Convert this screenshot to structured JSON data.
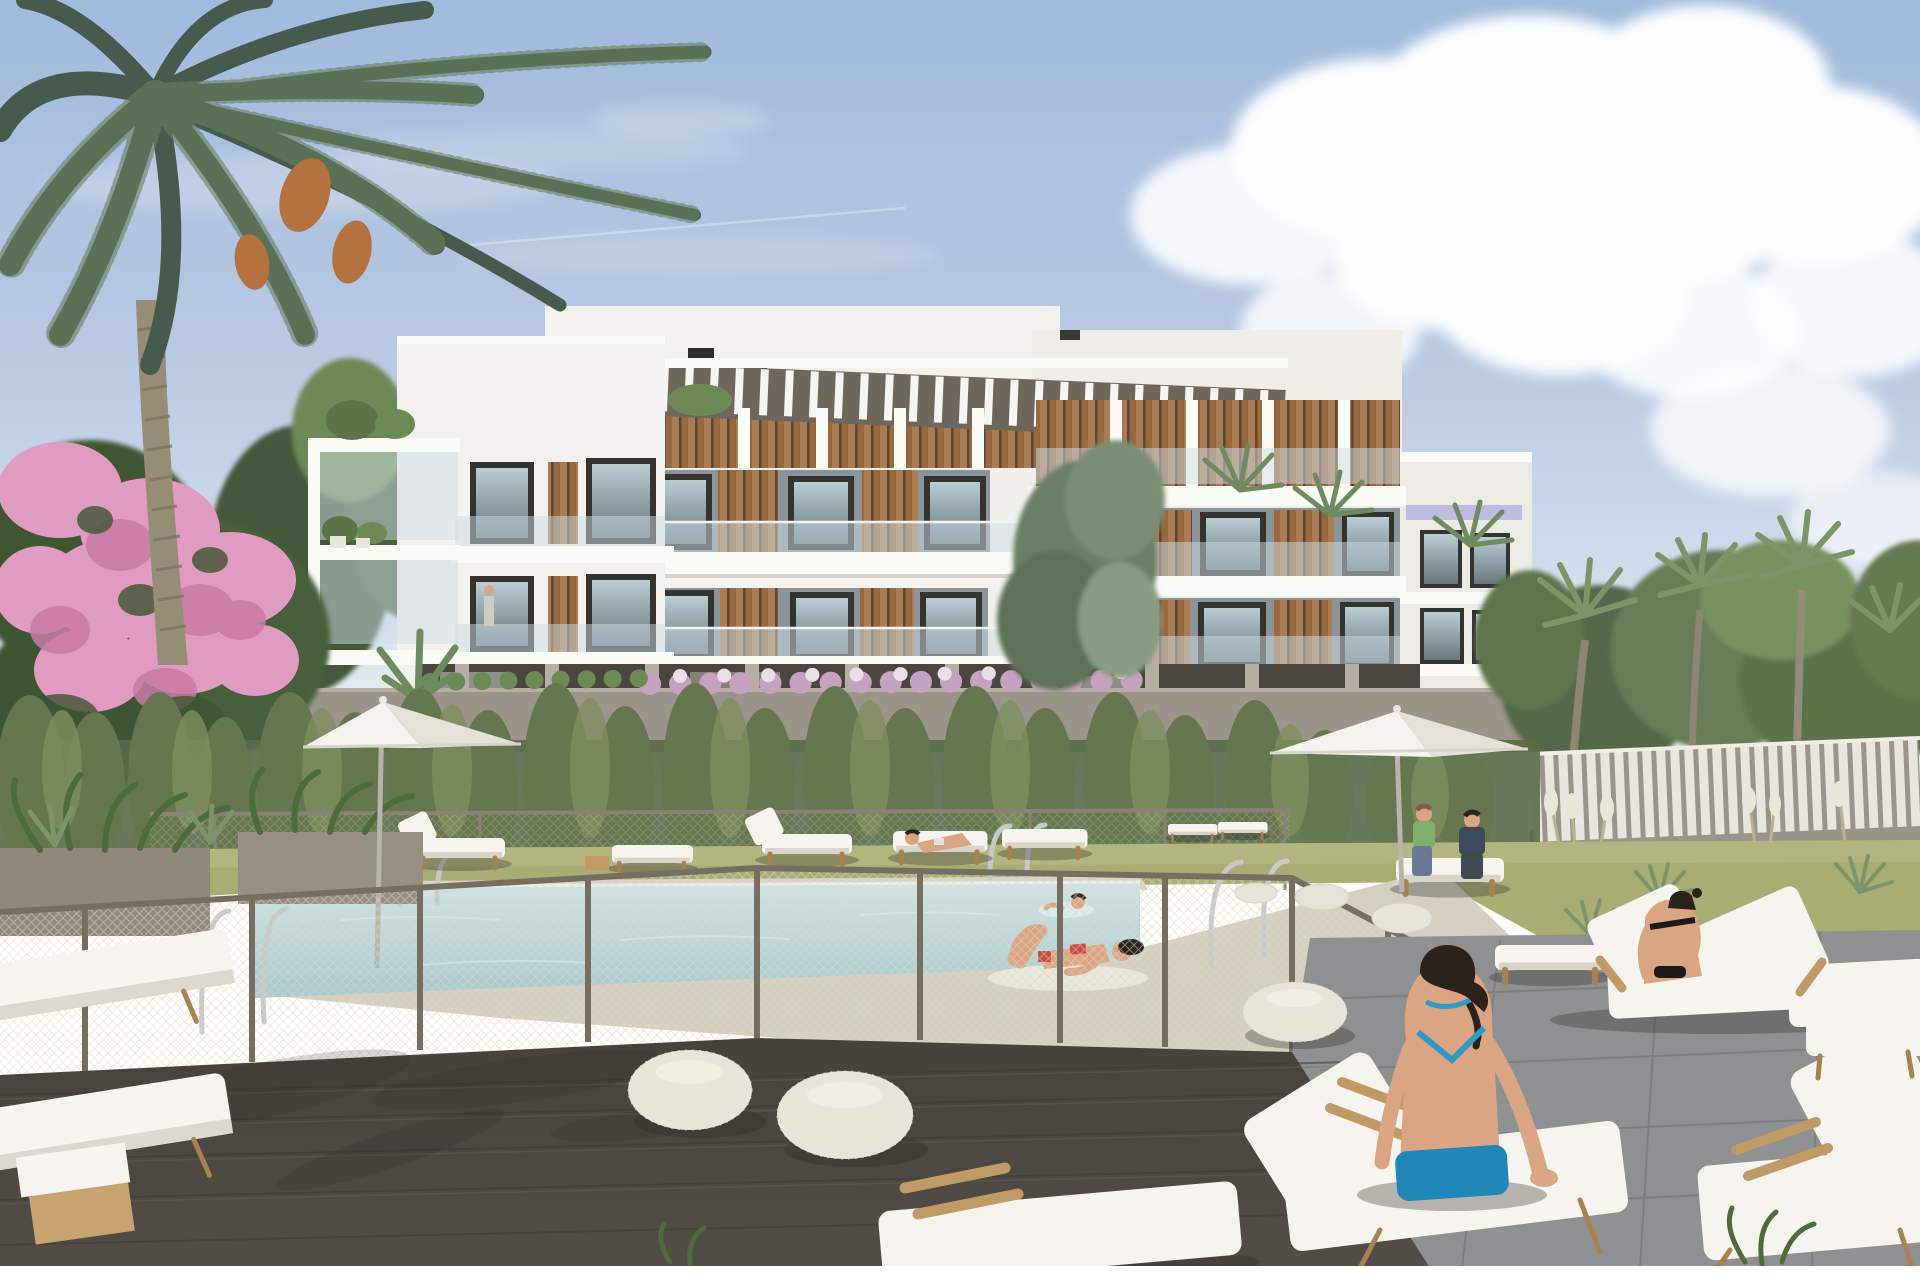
{
  "scene": {
    "type": "exterior architectural rendering",
    "description": "Modern white three-storey apartment building with timber louvres and a rooftop pergola behind a landscaped garden; fenced swimming pool with a swimmer and sunbathers, wooden deck with white sun loungers, knitted poufs, two white parasols, a tall date palm and a pink bougainvillea under a blue sky with cumulus clouds",
    "sky": {
      "clouds": "large cumulus on the right, thin haze and a faint contrail on the left"
    },
    "building": {
      "storeys": 3,
      "features": [
        "glass balcony railings",
        "timber louvre panels",
        "roof pergola",
        "pilotis ground floor",
        "roof chimneys"
      ]
    },
    "pool": {
      "enclosure": "chain-link fence",
      "ladders": 3,
      "swimmers": 1
    },
    "parasols": 2,
    "poufs": 6,
    "people": [
      {
        "where": "pool",
        "pose": "swimming"
      },
      {
        "where": "poolside deck",
        "pose": "lying on towel, red bikini"
      },
      {
        "where": "lounger behind pool",
        "pose": "sunbathing"
      },
      {
        "where": "garden loungers at right",
        "pose": "seated couple talking"
      },
      {
        "where": "double lounger right",
        "pose": "seated woman, black bikini"
      },
      {
        "where": "foreground deck",
        "pose": "woman seated from behind, blue bikini"
      }
    ],
    "vegetation": [
      "date palm",
      "pink bougainvillea",
      "conifers",
      "cypress hedge",
      "olive tree",
      "fan palms",
      "agaves",
      "white plume grasses"
    ]
  },
  "palette": {
    "sky_top": "#9fbbdd",
    "sky_mid": "#b5c7e2",
    "sky_horizon": "#e9eef1",
    "cloud": "#fdfdfd",
    "building_white": "#f2f1ed",
    "building_shade": "#ddd9d1",
    "slab": "#fafaf7",
    "window_frame": "#35332f",
    "glass_light": "#b9cdd3",
    "glass_dark": "#69787e",
    "louvre_wood": "#a87c54",
    "pergola_dark": "#6e675e",
    "pilotis_shadow": "#4a463f",
    "column": "#b5afa4",
    "garden_wall": "#9b948a",
    "flower_purple": "#c5a3c0",
    "bougainvillea": "#df9cc0",
    "conifer": "#44583a",
    "foliage": "#5d7348",
    "hedge": "#66764e",
    "grass": "#a8ad74",
    "agave": "#7d9468",
    "water": "#b9d6da",
    "water_far": "#cfe4e6",
    "pool_deck": "#d8d3c5",
    "mesh": "#ded8c6",
    "fence_post": "#776e62",
    "deck_dark": "#524d46",
    "stone": "#8f9092",
    "slat_fence": "#e9e6df",
    "wood": "#bf9a66",
    "cushion": "#f6f4ee",
    "pouf": "#e7e4da",
    "parasol": "#f3f2ee",
    "chrome": "#c7c9c8",
    "skin": "#d9a583",
    "hair": "#2b221c",
    "bikini_red": "#c84b44",
    "bikini_blue": "#2e9ac4",
    "towel_blue": "#2187b8",
    "top_green": "#7fae6a",
    "top_navy": "#3f4a5c",
    "swimsuit_black": "#1d1a18",
    "palm_green": "#465b4d",
    "palm_light": "#65805f",
    "palm_trunk": "#968d77",
    "dates_orange": "#b5713f"
  }
}
